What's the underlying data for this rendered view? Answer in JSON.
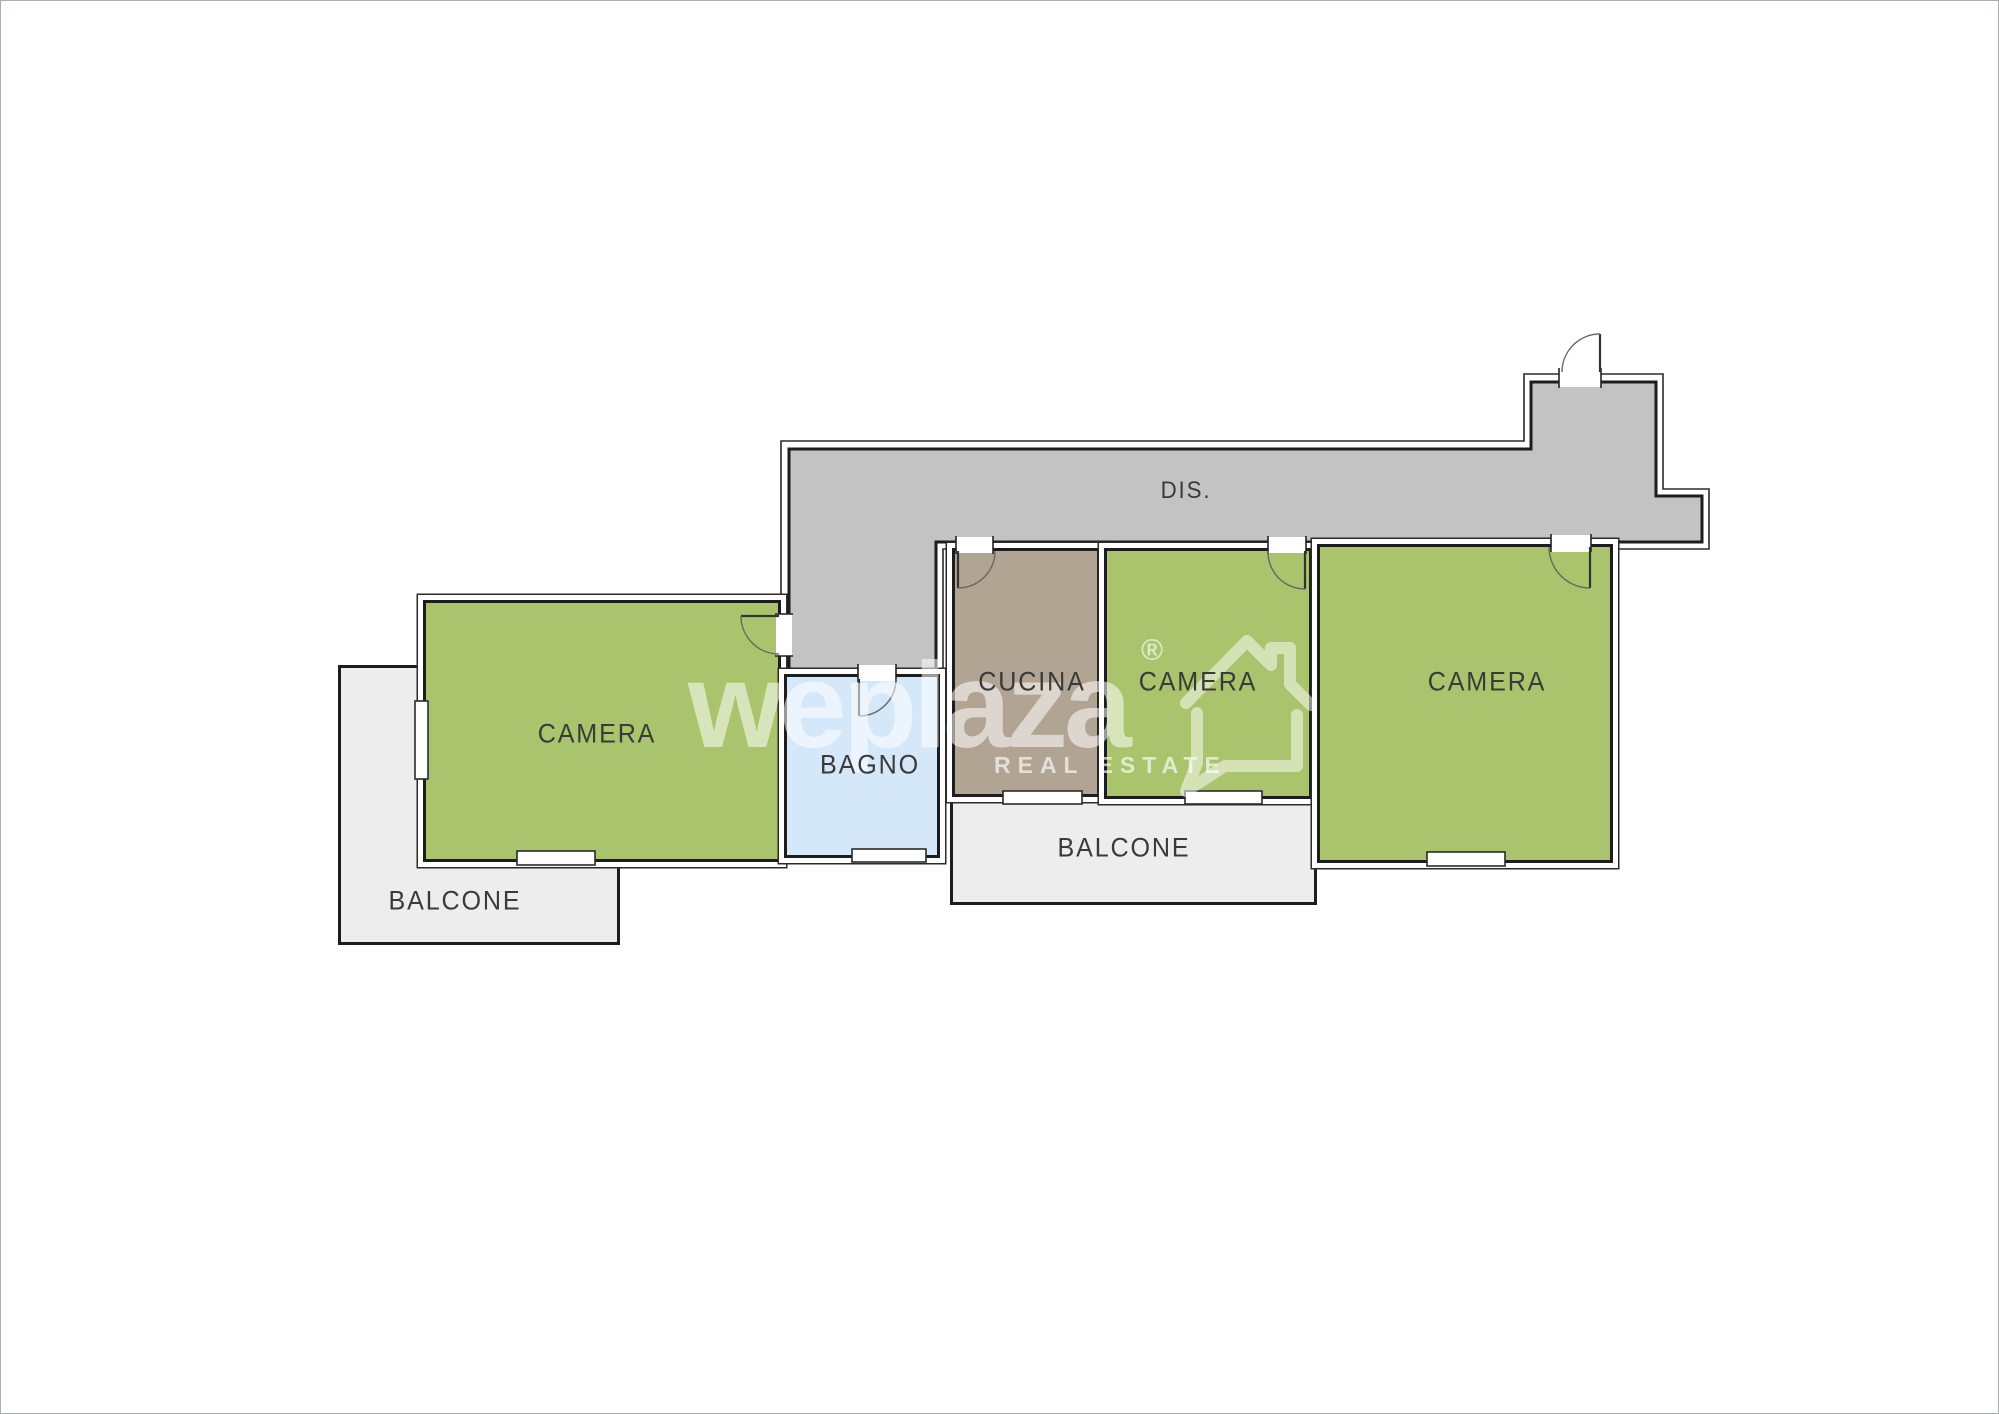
{
  "plan": {
    "rooms": [
      {
        "id": "dis",
        "label": "DIS."
      },
      {
        "id": "camera-left",
        "label": "CAMERA"
      },
      {
        "id": "bagno",
        "label": "BAGNO"
      },
      {
        "id": "cucina",
        "label": "CUCINA"
      },
      {
        "id": "camera-mid",
        "label": "CAMERA"
      },
      {
        "id": "camera-right",
        "label": "CAMERA"
      },
      {
        "id": "balcone-left",
        "label": "BALCONE"
      },
      {
        "id": "balcone-bottom",
        "label": "BALCONE"
      }
    ],
    "colors": {
      "bedroom_green": "#a9c46c",
      "corridor_gray": "#c3c3c3",
      "kitchen_taupe": "#b2a492",
      "bathroom_blue": "#d4e8fa",
      "balcony_gray": "#ededed",
      "wall_dark": "#1d1d1d"
    }
  },
  "watermark": {
    "brand": "weplaza",
    "registered": "®",
    "tagline": "REAL ESTATE"
  }
}
